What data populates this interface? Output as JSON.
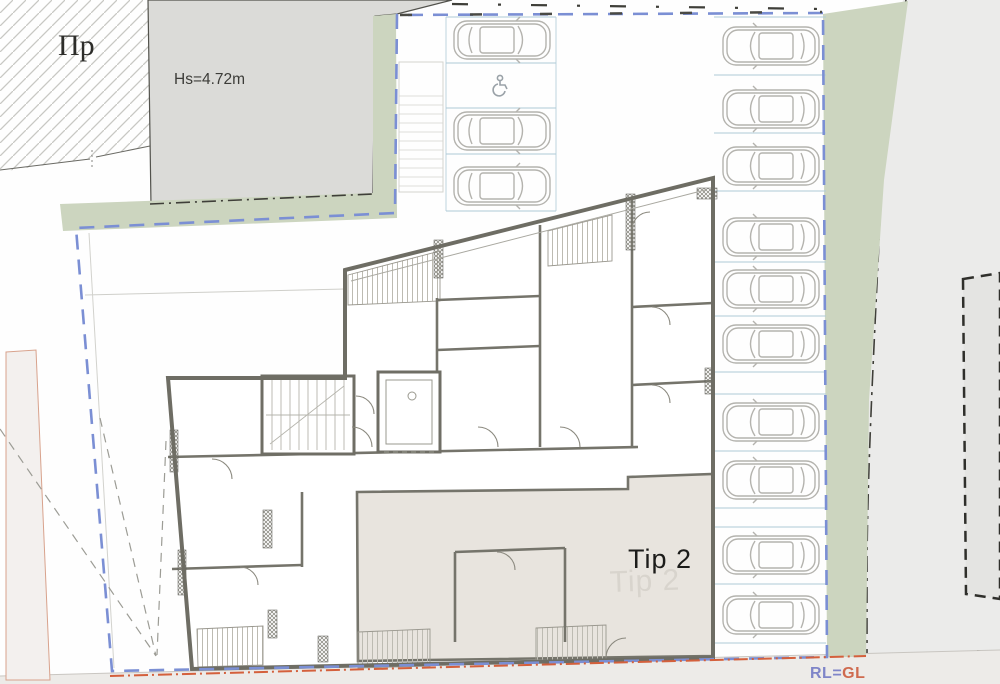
{
  "labels": {
    "adjacent_plot": "Пр",
    "height_note": "Hs=4.72m",
    "unit_label": "Tip 2",
    "unit_watermark": "Tip 2",
    "level_rl": "RL=",
    "level_gl": "GL"
  },
  "colors": {
    "greenery": "#ccd5bf",
    "boundary_blue": "#7b8fd4",
    "boundary_orange": "#d4603c",
    "neighbor_block_gray": "#dbdbd8",
    "unit_fill": "#e8e4de",
    "wall": "#6e6d64",
    "car_outline": "#b4b3ae",
    "spot_line": "#aecad7",
    "rl_color": "#7f85c8",
    "gl_color": "#cf6a4e"
  },
  "parking": {
    "top_left_column": {
      "car_rows_y": [
        40,
        131,
        186
      ],
      "accessible_row_y": 85,
      "divider_rows_y": [
        17,
        63,
        108,
        154,
        211
      ]
    },
    "right_column": {
      "car_rows_y": [
        46,
        109,
        166,
        237,
        289,
        344,
        422,
        480,
        555,
        615
      ],
      "divider_rows_y": [
        17,
        75,
        133,
        191,
        262,
        316,
        372,
        394,
        451,
        508,
        527,
        584,
        643
      ]
    }
  }
}
